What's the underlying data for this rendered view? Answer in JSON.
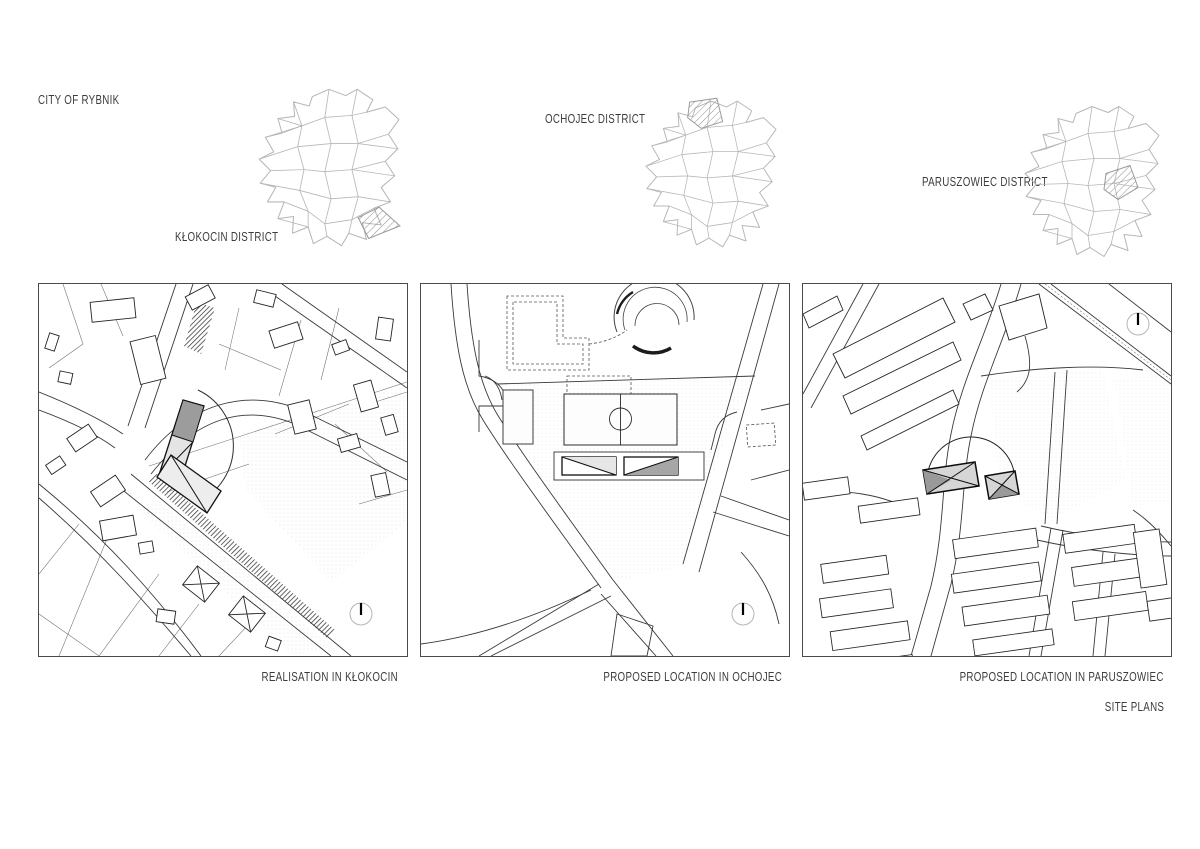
{
  "header": {
    "city_label": "CITY OF RYBNIK"
  },
  "district_maps": [
    {
      "id": "klokocin",
      "label": "KŁOKOCIN DISTRICT",
      "highlight_position": "bottom-right"
    },
    {
      "id": "ochojec",
      "label": "OCHOJEC DISTRICT",
      "highlight_position": "top-center"
    },
    {
      "id": "paruszowiec",
      "label": "PARUSZOWIEC DISTRICT",
      "highlight_position": "center-right"
    }
  ],
  "site_plans": [
    {
      "caption": "REALISATION IN KŁOKOCIN"
    },
    {
      "caption": "PROPOSED LOCATION IN OCHOJEC"
    },
    {
      "caption": "PROPOSED LOCATION IN PARUSZOWIEC"
    }
  ],
  "footer_label": "SITE PLANS",
  "icons": {
    "compass": "north-arrow-compass"
  },
  "colors": {
    "text": "#3c3c3c",
    "map_line": "#3a3a3a",
    "district_line": "#b5b5b5",
    "building_dark": "#9c9c9c",
    "building_light": "#e4e4e4",
    "background": "#ffffff"
  }
}
